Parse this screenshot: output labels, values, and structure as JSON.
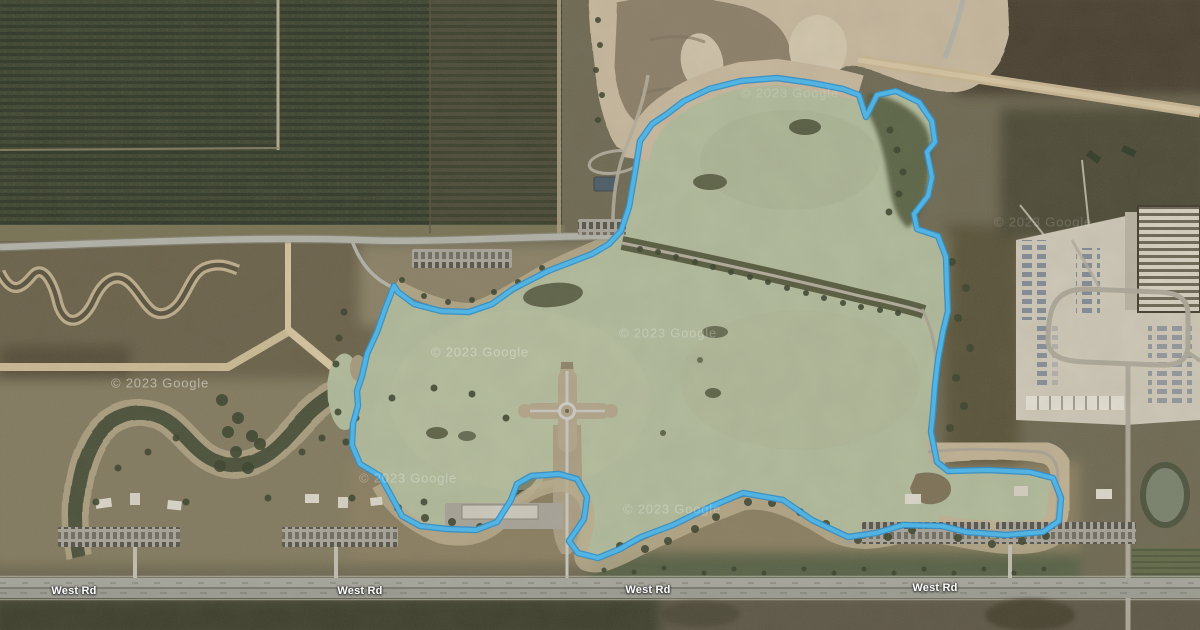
{
  "map": {
    "provider_watermark": "© 2023 Google",
    "watermarks": [
      {
        "x": 160,
        "y": 383,
        "opacity": 0.45
      },
      {
        "x": 480,
        "y": 352,
        "opacity": 0.32
      },
      {
        "x": 668,
        "y": 333,
        "opacity": 0.25
      },
      {
        "x": 408,
        "y": 478,
        "opacity": 0.28
      },
      {
        "x": 672,
        "y": 509,
        "opacity": 0.25
      },
      {
        "x": 790,
        "y": 93,
        "opacity": 0.16
      },
      {
        "x": 1043,
        "y": 222,
        "opacity": 0.16
      }
    ],
    "road_labels": [
      {
        "text": "West Rd",
        "x": 74,
        "y": 591
      },
      {
        "text": "West Rd",
        "x": 360,
        "y": 591
      },
      {
        "text": "West Rd",
        "x": 648,
        "y": 590
      },
      {
        "text": "West Rd",
        "x": 935,
        "y": 588
      }
    ],
    "route": {
      "stroke_core": "#4ab7ed",
      "stroke_casing": "#2b8ecb",
      "points": [
        [
          609,
          244
        ],
        [
          621,
          231
        ],
        [
          629,
          207
        ],
        [
          636,
          166
        ],
        [
          640,
          141
        ],
        [
          652,
          124
        ],
        [
          667,
          114
        ],
        [
          684,
          101
        ],
        [
          709,
          89
        ],
        [
          741,
          81
        ],
        [
          777,
          78
        ],
        [
          812,
          83
        ],
        [
          843,
          89
        ],
        [
          859,
          95
        ],
        [
          866,
          117
        ],
        [
          877,
          95
        ],
        [
          896,
          91
        ],
        [
          919,
          102
        ],
        [
          932,
          121
        ],
        [
          935,
          142
        ],
        [
          927,
          152
        ],
        [
          932,
          177
        ],
        [
          928,
          196
        ],
        [
          914,
          214
        ],
        [
          917,
          229
        ],
        [
          938,
          236
        ],
        [
          946,
          257
        ],
        [
          947,
          287
        ],
        [
          948,
          311
        ],
        [
          943,
          332
        ],
        [
          938,
          360
        ],
        [
          935,
          386
        ],
        [
          933,
          412
        ],
        [
          931,
          432
        ],
        [
          937,
          462
        ],
        [
          948,
          471
        ],
        [
          988,
          470
        ],
        [
          1030,
          472
        ],
        [
          1053,
          478
        ],
        [
          1061,
          498
        ],
        [
          1059,
          521
        ],
        [
          1043,
          532
        ],
        [
          1006,
          535
        ],
        [
          966,
          532
        ],
        [
          942,
          526
        ],
        [
          903,
          525
        ],
        [
          876,
          533
        ],
        [
          848,
          537
        ],
        [
          812,
          520
        ],
        [
          783,
          500
        ],
        [
          743,
          493
        ],
        [
          710,
          507
        ],
        [
          673,
          525
        ],
        [
          641,
          537
        ],
        [
          620,
          549
        ],
        [
          598,
          558
        ],
        [
          578,
          553
        ],
        [
          569,
          541
        ],
        [
          584,
          519
        ],
        [
          587,
          497
        ],
        [
          577,
          479
        ],
        [
          559,
          474
        ],
        [
          531,
          476
        ],
        [
          517,
          484
        ],
        [
          511,
          500
        ],
        [
          497,
          522
        ],
        [
          476,
          530
        ],
        [
          447,
          529
        ],
        [
          420,
          526
        ],
        [
          402,
          516
        ],
        [
          389,
          492
        ],
        [
          380,
          476
        ],
        [
          360,
          464
        ],
        [
          352,
          445
        ],
        [
          353,
          424
        ],
        [
          358,
          406
        ],
        [
          357,
          391
        ],
        [
          362,
          376
        ],
        [
          367,
          354
        ],
        [
          377,
          332
        ],
        [
          385,
          309
        ],
        [
          394,
          286
        ],
        [
          398,
          292
        ],
        [
          414,
          304
        ],
        [
          441,
          311
        ],
        [
          469,
          312
        ],
        [
          492,
          304
        ],
        [
          513,
          289
        ],
        [
          548,
          271
        ],
        [
          592,
          254
        ],
        [
          609,
          244
        ]
      ]
    },
    "colors": {
      "water": "#b2bb9c",
      "sand": "#c7b89e",
      "scrub": "#6e6852",
      "field": "#3c432f",
      "road": "#b3b3aa"
    }
  }
}
